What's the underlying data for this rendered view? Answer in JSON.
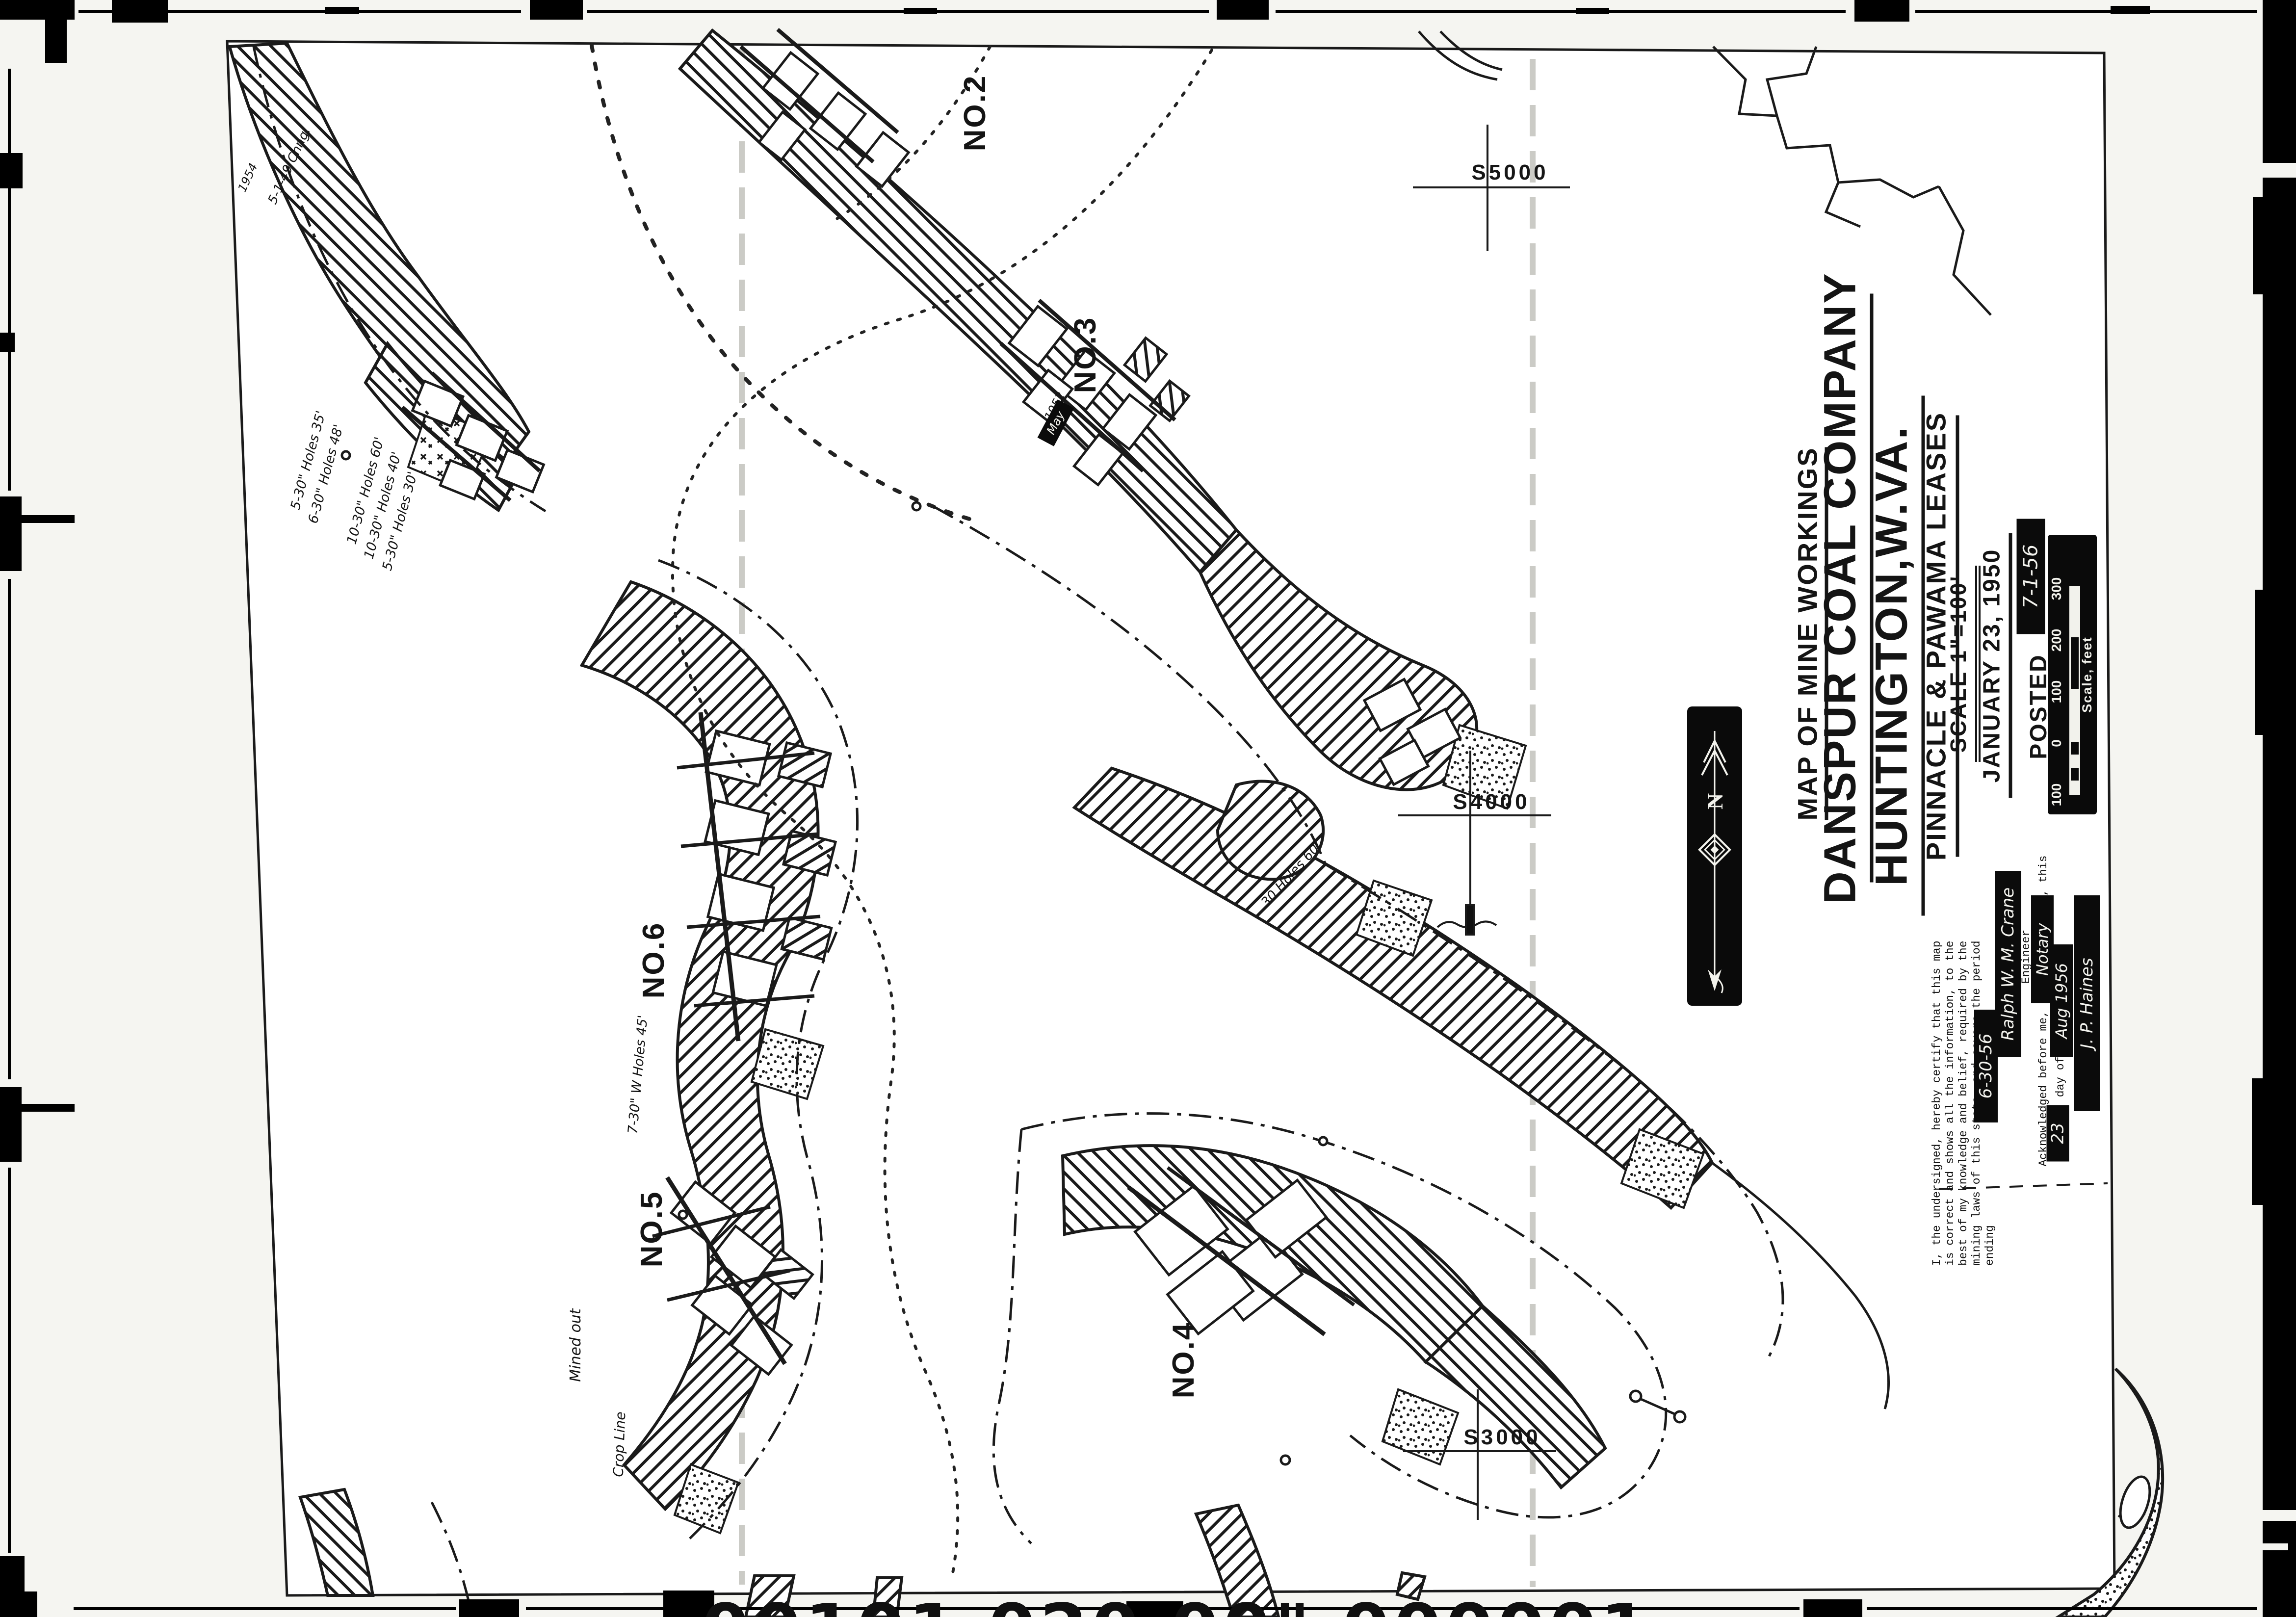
{
  "title_block": {
    "heading": "MAP OF MINE WORKINGS",
    "company": "DANSPUR COAL COMPANY",
    "location": "HUNTINGTON,W.VA.",
    "leases": "PINNACLE & PAWAMA LEASES",
    "scale": "SCALE 1\"=100'",
    "date": "JANUARY 23, 1950",
    "posted_label": "POSTED",
    "posted_date": "7-1-56"
  },
  "scale_bar": {
    "caption": "Scale, feet",
    "ticks": [
      "100",
      "0",
      "100",
      "200",
      "300"
    ]
  },
  "north_arrow": {
    "label": "N"
  },
  "certification": {
    "line1": "I, the undersigned, hereby certify that this map",
    "line2": "is correct and shows all the information, to the",
    "line3": "best of my knowledge and belief, required by the",
    "line4": "mining laws of this state, and covers the period",
    "line5": "ending",
    "ending_date": "6-30-56",
    "signature": "Ralph W. M. Crane",
    "signer_title": "Engineer",
    "ack_text": "Acknowledged before me, a",
    "ack_notary": "Notary",
    "ack_this": ", this",
    "ack_day": "23",
    "ack_day_of": "day of",
    "ack_month_year": "Aug 1956",
    "notary_signature": "J. P. Haines"
  },
  "mine_labels": {
    "no2": "NO.2",
    "no3": "NO.3",
    "no4": "NO.4",
    "no5": "NO.5",
    "no6": "NO.6"
  },
  "grid_labels": {
    "s5000": "S5000",
    "s4000": "S4000",
    "s3000": "S3000"
  },
  "annotations": {
    "holes1": "5-30\" Holes 35'",
    "holes2": "6-30\" Holes 48'",
    "holes3": "10-30\" Holes 60'",
    "holes4": "10-30\" Holes 40'",
    "holes5": "5-30\" Holes 30'",
    "holes6": "7-30\" W Holes 45'",
    "holes7": "30 Holes 60'",
    "mined_out": "Mined out",
    "crop_line": "Crop Line",
    "chg1": "5-1-49 Chng.",
    "yr1954": "1954",
    "yr1952": "1952",
    "may": "May"
  },
  "film_strip": {
    "digits": "00101 020  00\"  000001"
  }
}
